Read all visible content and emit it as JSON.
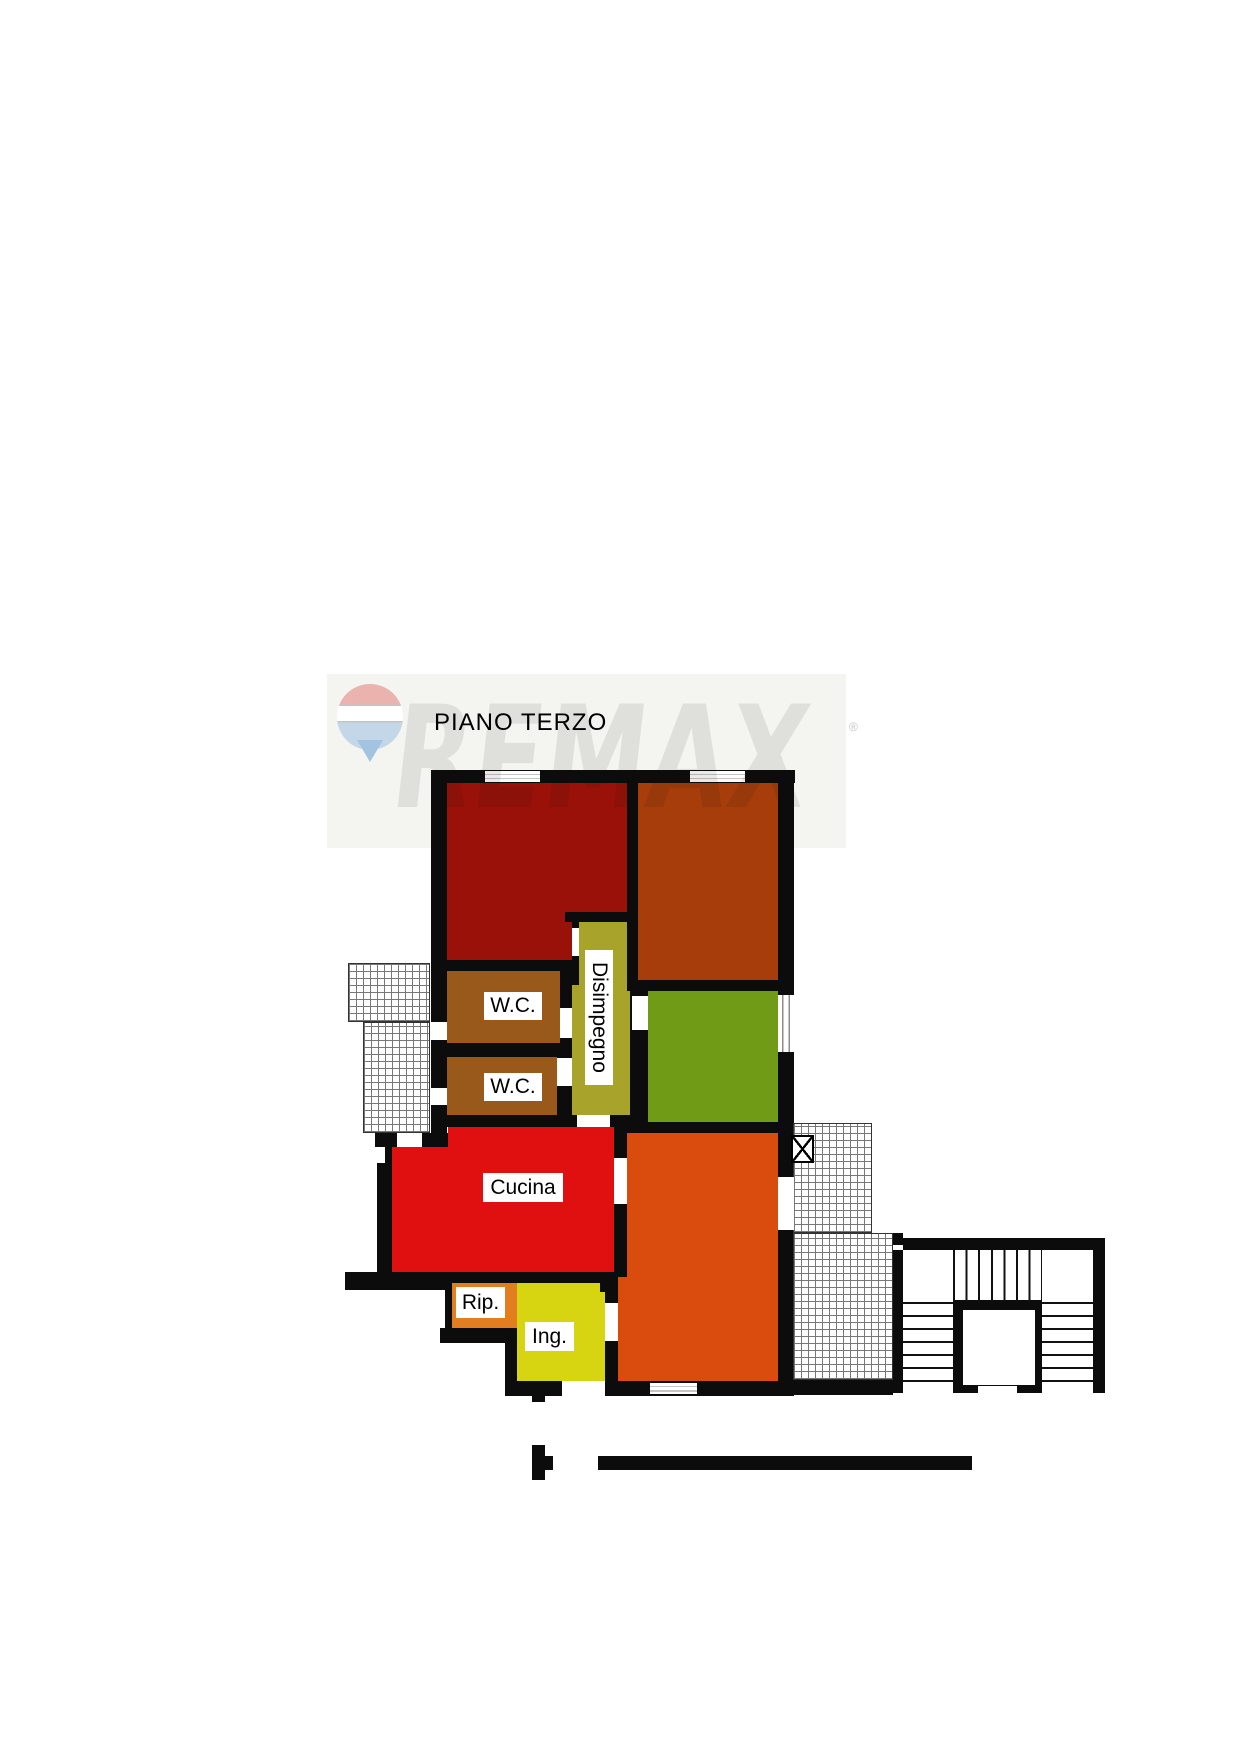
{
  "title": "PIANO TERZO",
  "watermark": {
    "brand_text": "REMAX",
    "registered_mark": "®",
    "band_color": "#f4f4f1",
    "balloon_red": "#eab3ad",
    "balloon_blue": "#c3d7e9",
    "letter_color": "#dcdcda"
  },
  "icons": {
    "balloon": "remax-balloon-icon",
    "window_box": "crossed-box-window-icon"
  },
  "floor_plan": {
    "wall_color": "#0c0c0c",
    "rooms": {
      "bedroom_left": {
        "label": "",
        "color": "#991108"
      },
      "bedroom_right": {
        "label": "",
        "color": "#a63d0b"
      },
      "wc_top": {
        "label": "W.C.",
        "color": "#99591b"
      },
      "wc_bottom": {
        "label": "W.C.",
        "color": "#99591b"
      },
      "disimpegno": {
        "label": "Disimpegno",
        "color": "#a8a32a"
      },
      "room_green": {
        "label": "",
        "color": "#709b17"
      },
      "cucina": {
        "label": "Cucina",
        "color": "#e01010"
      },
      "living_orange": {
        "label": "",
        "color": "#d94c0e"
      },
      "rip": {
        "label": "Rip.",
        "color": "#e27d20"
      },
      "ing": {
        "label": "Ing.",
        "color": "#d7d411"
      }
    }
  }
}
